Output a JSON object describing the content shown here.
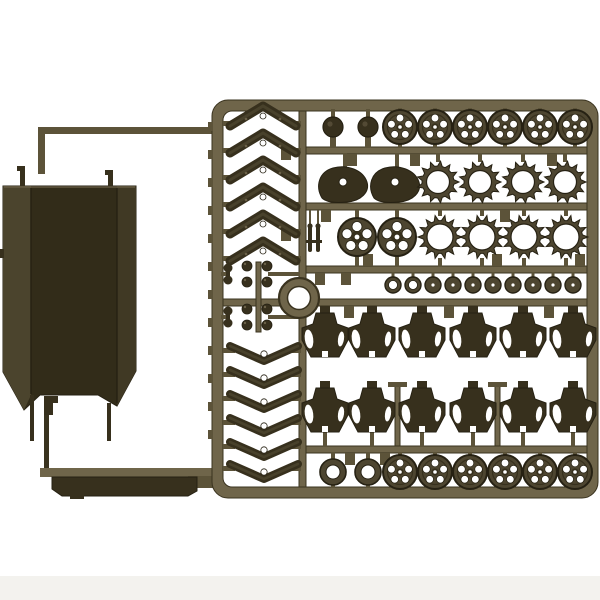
{
  "meta": {
    "subject": "olive-drab plastic model kit sprue with tank running-gear parts and large hull panel",
    "background": "#ffffff"
  },
  "palette": {
    "bg": "#ffffff",
    "shadow": "#f3f2ee",
    "runner_light": "#6f654a",
    "runner_mid": "#5c5339",
    "runner_dark": "#3a331f",
    "part_fill": "#4d4530",
    "part_dark": "#37301d",
    "part_edge": "#262113",
    "panel_face": "#322c19",
    "panel_left": "#4b442d",
    "panel_right": "#403924",
    "hole": "#ffffff",
    "detail_light": "#6b6148"
  },
  "panel": {
    "outline": "3,186 136,186 136,371 117,406 98,395 40,395 24,410 3,372",
    "left_fold": "3,186 31,186 31,395 24,410 3,372",
    "right_fold": "117,186 136,186 136,371 117,406",
    "seams": [
      [
        31,
        188,
        31,
        394
      ],
      [
        117,
        188,
        117,
        403
      ]
    ],
    "prongs": [
      [
        30,
        395,
        4,
        46
      ],
      [
        107,
        403,
        4,
        38
      ]
    ],
    "hooks": [
      [
        20,
        168,
        5,
        18
      ],
      [
        108,
        172,
        5,
        14
      ]
    ],
    "hook_caps": [
      [
        17,
        166,
        8,
        5
      ],
      [
        105,
        170,
        8,
        5
      ]
    ],
    "bracket": [
      [
        44,
        396,
        14,
        7
      ],
      [
        44,
        403,
        9,
        12
      ]
    ],
    "left_nub": [
      0,
      249,
      4,
      9
    ]
  },
  "left_runner": {
    "top_h": [
      38,
      127,
      180,
      7
    ],
    "top_v": [
      38,
      127,
      7,
      47
    ],
    "stem_v": [
      44,
      396,
      5,
      76
    ],
    "bottom_h": [
      40,
      468,
      178,
      9
    ],
    "strip_outline": "52,477 197,477 197,491 188,496 62,496 52,489",
    "strip_tab": [
      70,
      493,
      14,
      6
    ],
    "right_step": [
      188,
      476,
      29,
      12
    ]
  },
  "frame": {
    "outer": [
      212,
      100,
      386,
      398,
      16
    ],
    "inner": [
      223,
      111,
      364,
      376,
      9
    ],
    "ticks_left": [
      122,
      150,
      178,
      206,
      234,
      262,
      290,
      318,
      346,
      374,
      402,
      430
    ],
    "tick_size": [
      5,
      9
    ]
  },
  "bars": [
    [
      302,
      147,
      285,
      7
    ],
    [
      302,
      203,
      285,
      7
    ],
    [
      302,
      266,
      285,
      7
    ],
    [
      223,
      299,
      364,
      7
    ],
    [
      302,
      446,
      285,
      7
    ]
  ],
  "verticals": [
    [
      299,
      111,
      7,
      376
    ],
    [
      256,
      262,
      5,
      70
    ],
    [
      395,
      384,
      5,
      62
    ],
    [
      495,
      384,
      5,
      62
    ]
  ],
  "caps": [
    [
      388,
      382,
      19,
      5
    ],
    [
      488,
      382,
      19,
      5
    ]
  ],
  "tabs": [
    [
      352,
      154
    ],
    [
      415,
      154
    ],
    [
      552,
      154
    ],
    [
      326,
      210
    ],
    [
      505,
      210
    ],
    [
      368,
      254
    ],
    [
      497,
      254
    ],
    [
      580,
      254
    ],
    [
      320,
      273
    ],
    [
      346,
      273
    ],
    [
      349,
      306
    ],
    [
      449,
      306
    ],
    [
      549,
      306
    ],
    [
      350,
      453
    ],
    [
      385,
      453
    ],
    [
      286,
      148
    ],
    [
      286,
      229
    ]
  ],
  "parts": {
    "knobs_top": {
      "y": 127,
      "xs": [
        333,
        368
      ],
      "r": 10
    },
    "wheels_top": {
      "y": 127,
      "xs": [
        400,
        435,
        470,
        505,
        540,
        575
      ],
      "r": 17
    },
    "teardrops": {
      "y": 184,
      "xs": [
        345,
        397
      ]
    },
    "sprockets": {
      "y": 182,
      "xs": [
        438,
        480,
        523,
        565
      ],
      "r_tip": 21,
      "r_base": 16,
      "r_hole": 11.5,
      "teeth": 13
    },
    "spoked_discs": {
      "y": 237,
      "xs": [
        357,
        397
      ],
      "r": 19
    },
    "star_rings": {
      "y": 237,
      "xs": [
        440,
        482,
        524,
        566
      ],
      "r_tip": 22,
      "r_base": 16.5,
      "r_hole": 13,
      "teeth": 14
    },
    "pins": {
      "y": 238,
      "xs": [
        310,
        318
      ]
    },
    "small_discs": {
      "y": 285,
      "x0": 393,
      "dx": 20,
      "count": 10,
      "open": 2,
      "r": 8
    },
    "bogies_a": {
      "top": 313,
      "xs": [
        325,
        372,
        422,
        473,
        523,
        573
      ]
    },
    "bogies_b": {
      "top": 388,
      "xs": [
        325,
        372,
        422,
        473,
        523,
        573
      ]
    },
    "rings_bottom": {
      "y": 472,
      "xs": [
        333,
        368
      ],
      "r": 13,
      "r_hole": 7
    },
    "wheels_bottom": {
      "y": 472,
      "xs": [
        400,
        435,
        470,
        505,
        540,
        575
      ],
      "r": 17
    },
    "chevrons": {
      "cx": 263,
      "ys": [
        115,
        142,
        169,
        196,
        223,
        250
      ]
    },
    "wishbones": {
      "cx": 264,
      "ys": [
        352,
        376,
        400,
        424,
        448,
        470
      ]
    },
    "clusters": {
      "ys": [
        274,
        317
      ]
    },
    "ring_large": {
      "cx": 299,
      "cy": 298,
      "r": 20,
      "r_hole": 11.5
    }
  }
}
